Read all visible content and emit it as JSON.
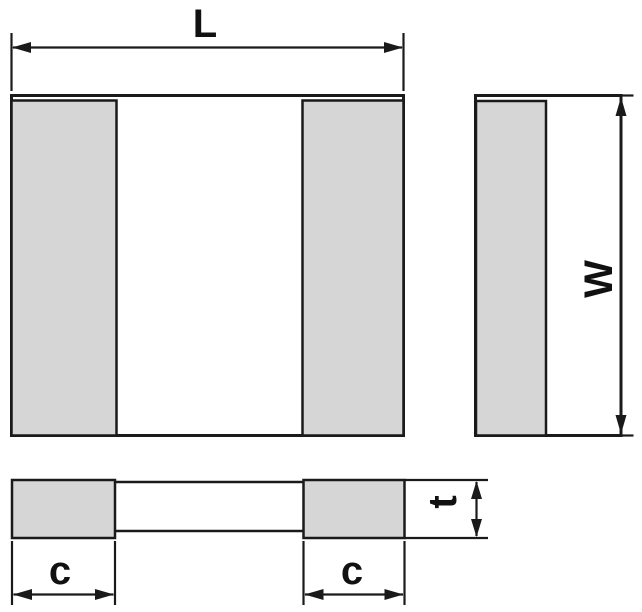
{
  "diagram": {
    "labels": {
      "length": "L",
      "width": "W",
      "thickness": "t",
      "cap_left": "c",
      "cap_right": "c"
    },
    "colors": {
      "line": "#1a1a1a",
      "termination_fill": "#d6d6d6",
      "body_fill": "#ffffff",
      "background": "#ffffff"
    }
  }
}
